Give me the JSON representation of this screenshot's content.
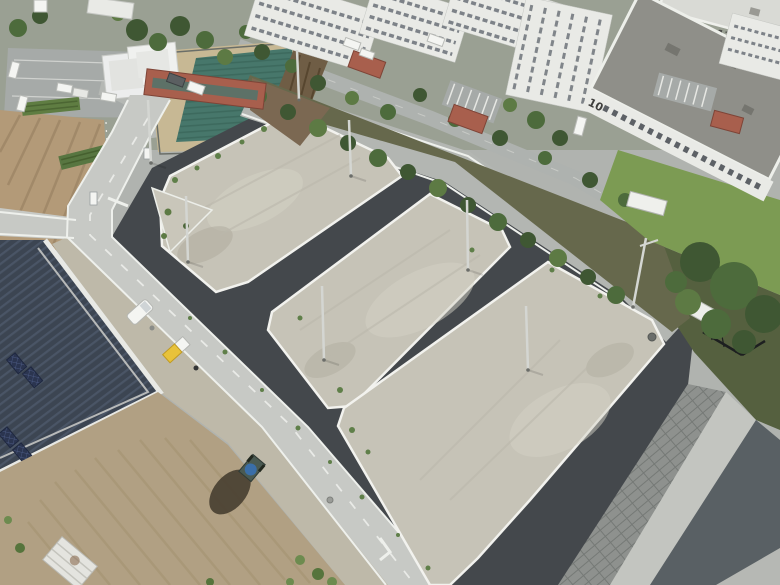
{
  "scene": {
    "labels": {
      "building_10": "10",
      "building_11": "11"
    }
  },
  "palette": {
    "asphalt": "#44484c",
    "concrete": "#c7c9c5",
    "road_gray": "#b3b6b2",
    "curb": "#f2f2ee",
    "gravel": "#c6c3b7",
    "gravel_light": "#d4d1c5",
    "navy_roof": "#3c4552",
    "white_wall": "#eceee9",
    "bldg_white": "#e9eae6",
    "bldg_roof": "#8f8f89",
    "hedge": "#66684c",
    "tree": "#3f5733",
    "bush": "#5d7a44",
    "lawn": "#7c9b53",
    "tarp": "#47776b",
    "sand": "#c7b894",
    "dirt_field": "#b1a083",
    "furrow": "#b39a78",
    "soil": "#564a38",
    "stone": "#8e918e",
    "canal": "#596064",
    "parking": "#a6aaa8",
    "red_roof": "#a85f4d",
    "car_white": "#f4f5f2",
    "truck_yellow": "#e8c23a",
    "embankment": "#6f5d45"
  }
}
